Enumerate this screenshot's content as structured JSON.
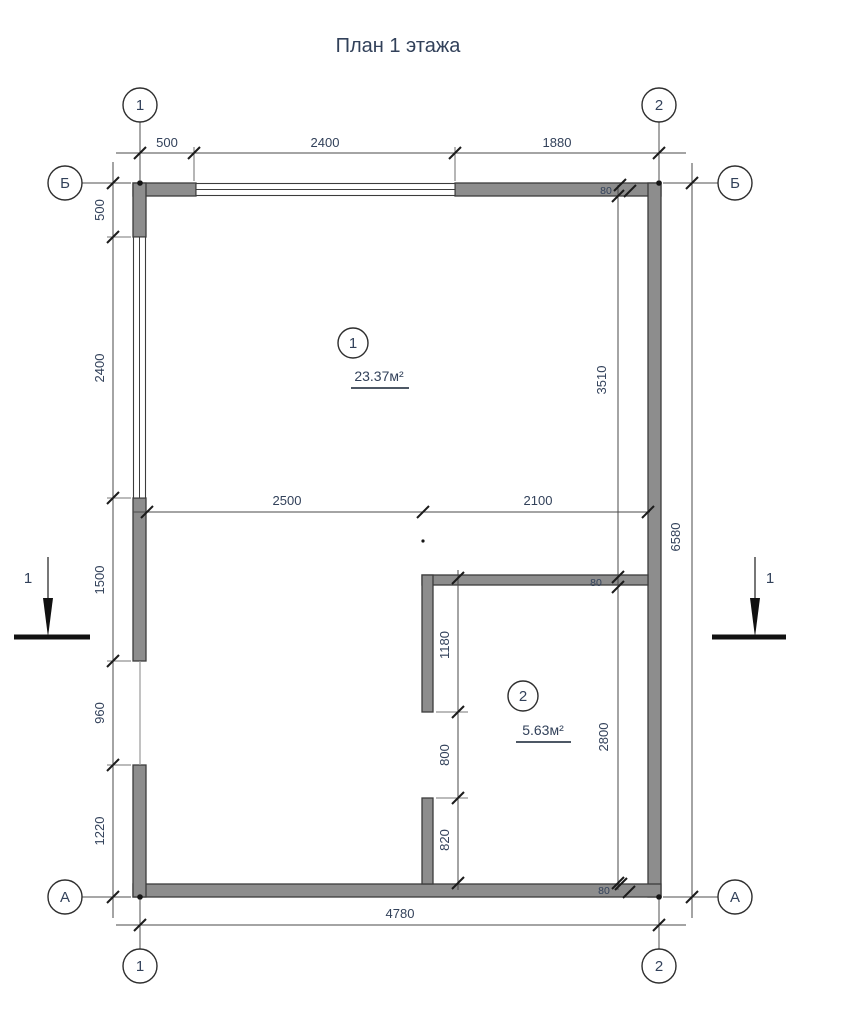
{
  "title": "План 1 этажа",
  "axes": {
    "column_1": "1",
    "column_2": "2",
    "row_b": "Б",
    "row_a": "А"
  },
  "rooms": [
    {
      "number": "1",
      "area": "23.37м²"
    },
    {
      "number": "2",
      "area": "5.63м²"
    }
  ],
  "dimensions": {
    "top": [
      "500",
      "2400",
      "1880"
    ],
    "left": [
      "500",
      "2400",
      "1500",
      "960",
      "1220"
    ],
    "middle": [
      "2500",
      "2100"
    ],
    "partition": [
      "1180",
      "800",
      "820"
    ],
    "right_inner": [
      "3510",
      "2800"
    ],
    "right_outer": "6580",
    "bottom": "4780",
    "wall_thickness": [
      "80",
      "80",
      "80"
    ]
  },
  "section_marks": {
    "left": "1",
    "right": "1"
  },
  "colors": {
    "wall_fill": "#8d8d8d",
    "wall_stroke": "#3c3c3c",
    "line": "#4a4a4a",
    "tick": "#1c1c1c",
    "text": "#32415a",
    "background": "#ffffff"
  }
}
